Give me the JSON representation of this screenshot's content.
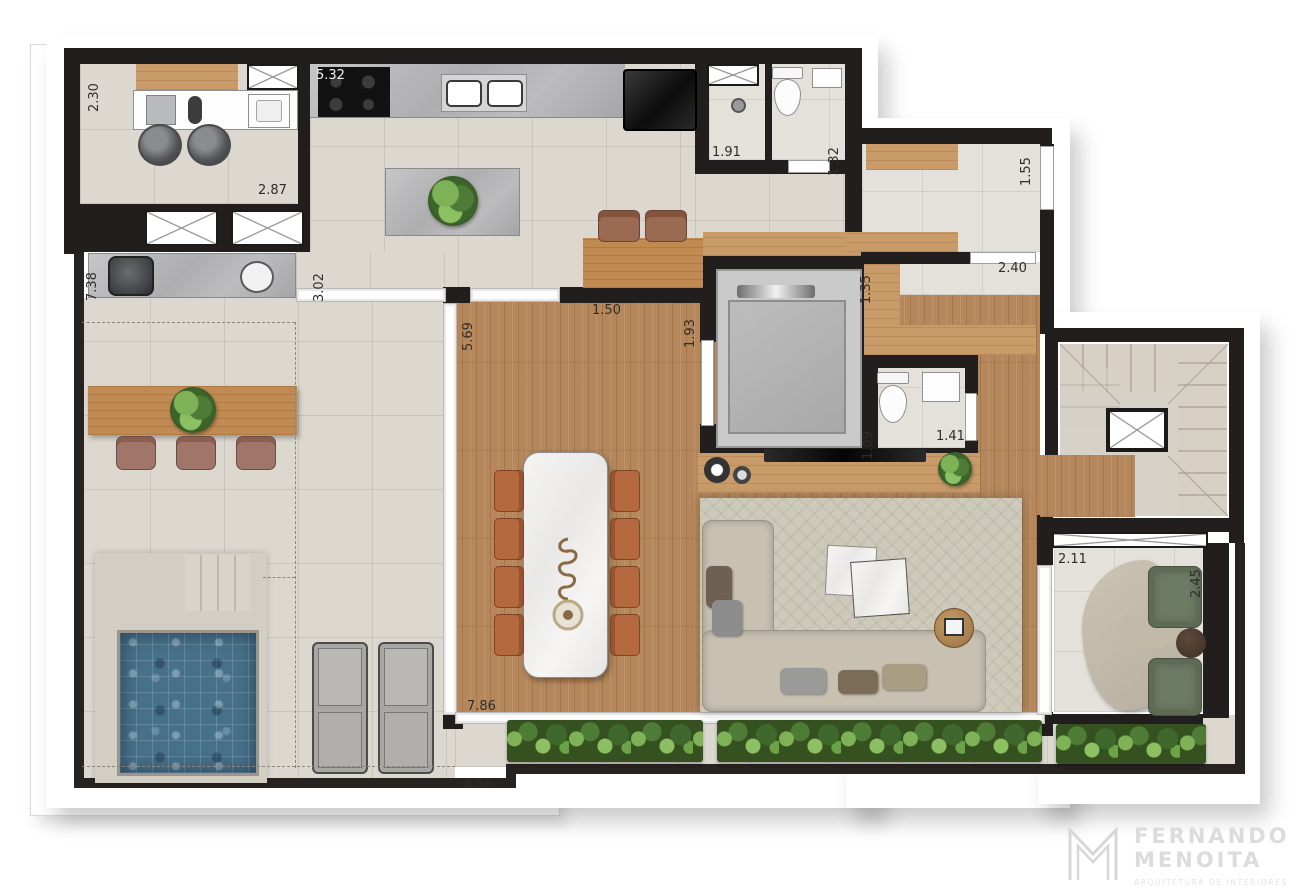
{
  "plan": {
    "type": "residential-floor-plan",
    "dims": {
      "d230": "2.30",
      "d532": "5.32",
      "d287": "2.87",
      "d191": "1.91",
      "d132": "1.32",
      "d155": "1.55",
      "d738": "7.38",
      "d302": "3.02",
      "d135": "1.35",
      "d240": "2.40",
      "d569": "5.69",
      "d150": "1.50",
      "d193": "1.93",
      "d109": "1.09",
      "d141": "1.41",
      "d211": "2.11",
      "d245": "2.45",
      "d786": "7.86",
      "d556": "5.56"
    },
    "colors": {
      "wall": "#211e1d",
      "tile": "#dcd8d0",
      "wood": "#b5875a",
      "pool": "#477089",
      "rug": "#cdcaba",
      "dining_chair": "#b4693e",
      "armchair": "#6d7a64",
      "foliage": "#4e7c36",
      "counter": "#b5b5b7"
    }
  },
  "logo": {
    "monogram": "M",
    "line1": "FERNANDO",
    "line2": "MENOITA",
    "tagline": "ARQUITETURA DE INTERIORES"
  }
}
